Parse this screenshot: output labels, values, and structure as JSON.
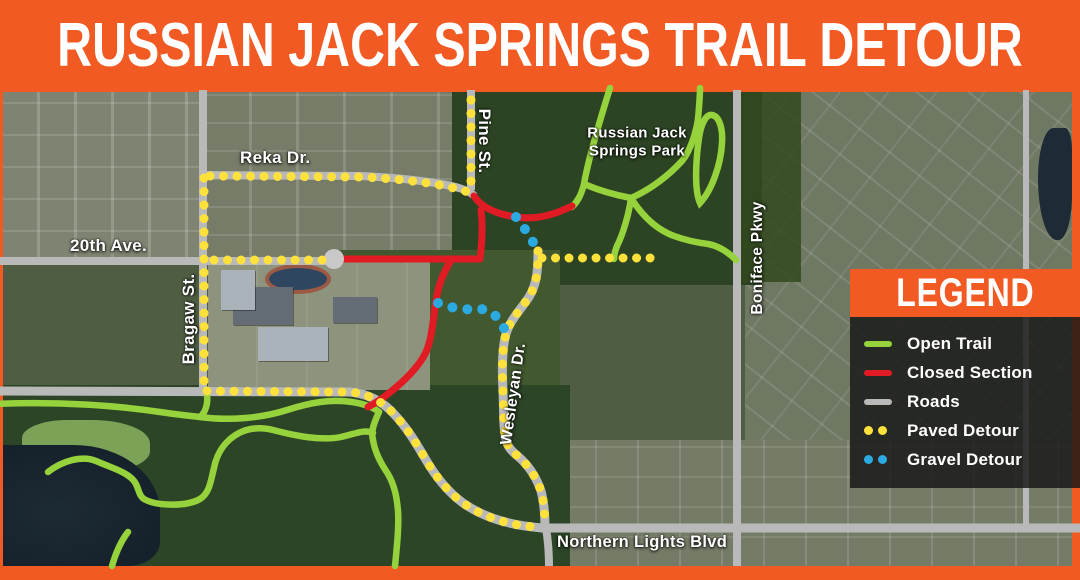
{
  "title": "RUSSIAN JACK SPRINGS TRAIL DETOUR",
  "colors": {
    "orange": "#F15A22",
    "open-trail": "#96D23C",
    "closed-section": "#E01B24",
    "road": "#B9B9B9",
    "paved-detour": "#FFE13B",
    "gravel-detour": "#2BAAE2"
  },
  "map_labels": {
    "reka": "Reka Dr.",
    "pine": "Pine St.",
    "park_line1": "Russian Jack",
    "park_line2": "Springs Park",
    "twentieth": "20th Ave.",
    "bragaw": "Bragaw St.",
    "wesleyan": "Wesleyan Dr.",
    "boniface": "Boniface Pkwy",
    "northern_lights": "Northern Lights Blvd"
  },
  "legend": {
    "title": "LEGEND",
    "items": [
      {
        "label": "Open Trail",
        "swatch": "line",
        "color_key": "open-trail"
      },
      {
        "label": "Closed Section",
        "swatch": "line",
        "color_key": "closed-section"
      },
      {
        "label": "Roads",
        "swatch": "line",
        "color_key": "road"
      },
      {
        "label": "Paved Detour",
        "swatch": "dots",
        "color_key": "paved-detour"
      },
      {
        "label": "Gravel Detour",
        "swatch": "dots",
        "color_key": "gravel-detour"
      }
    ]
  }
}
